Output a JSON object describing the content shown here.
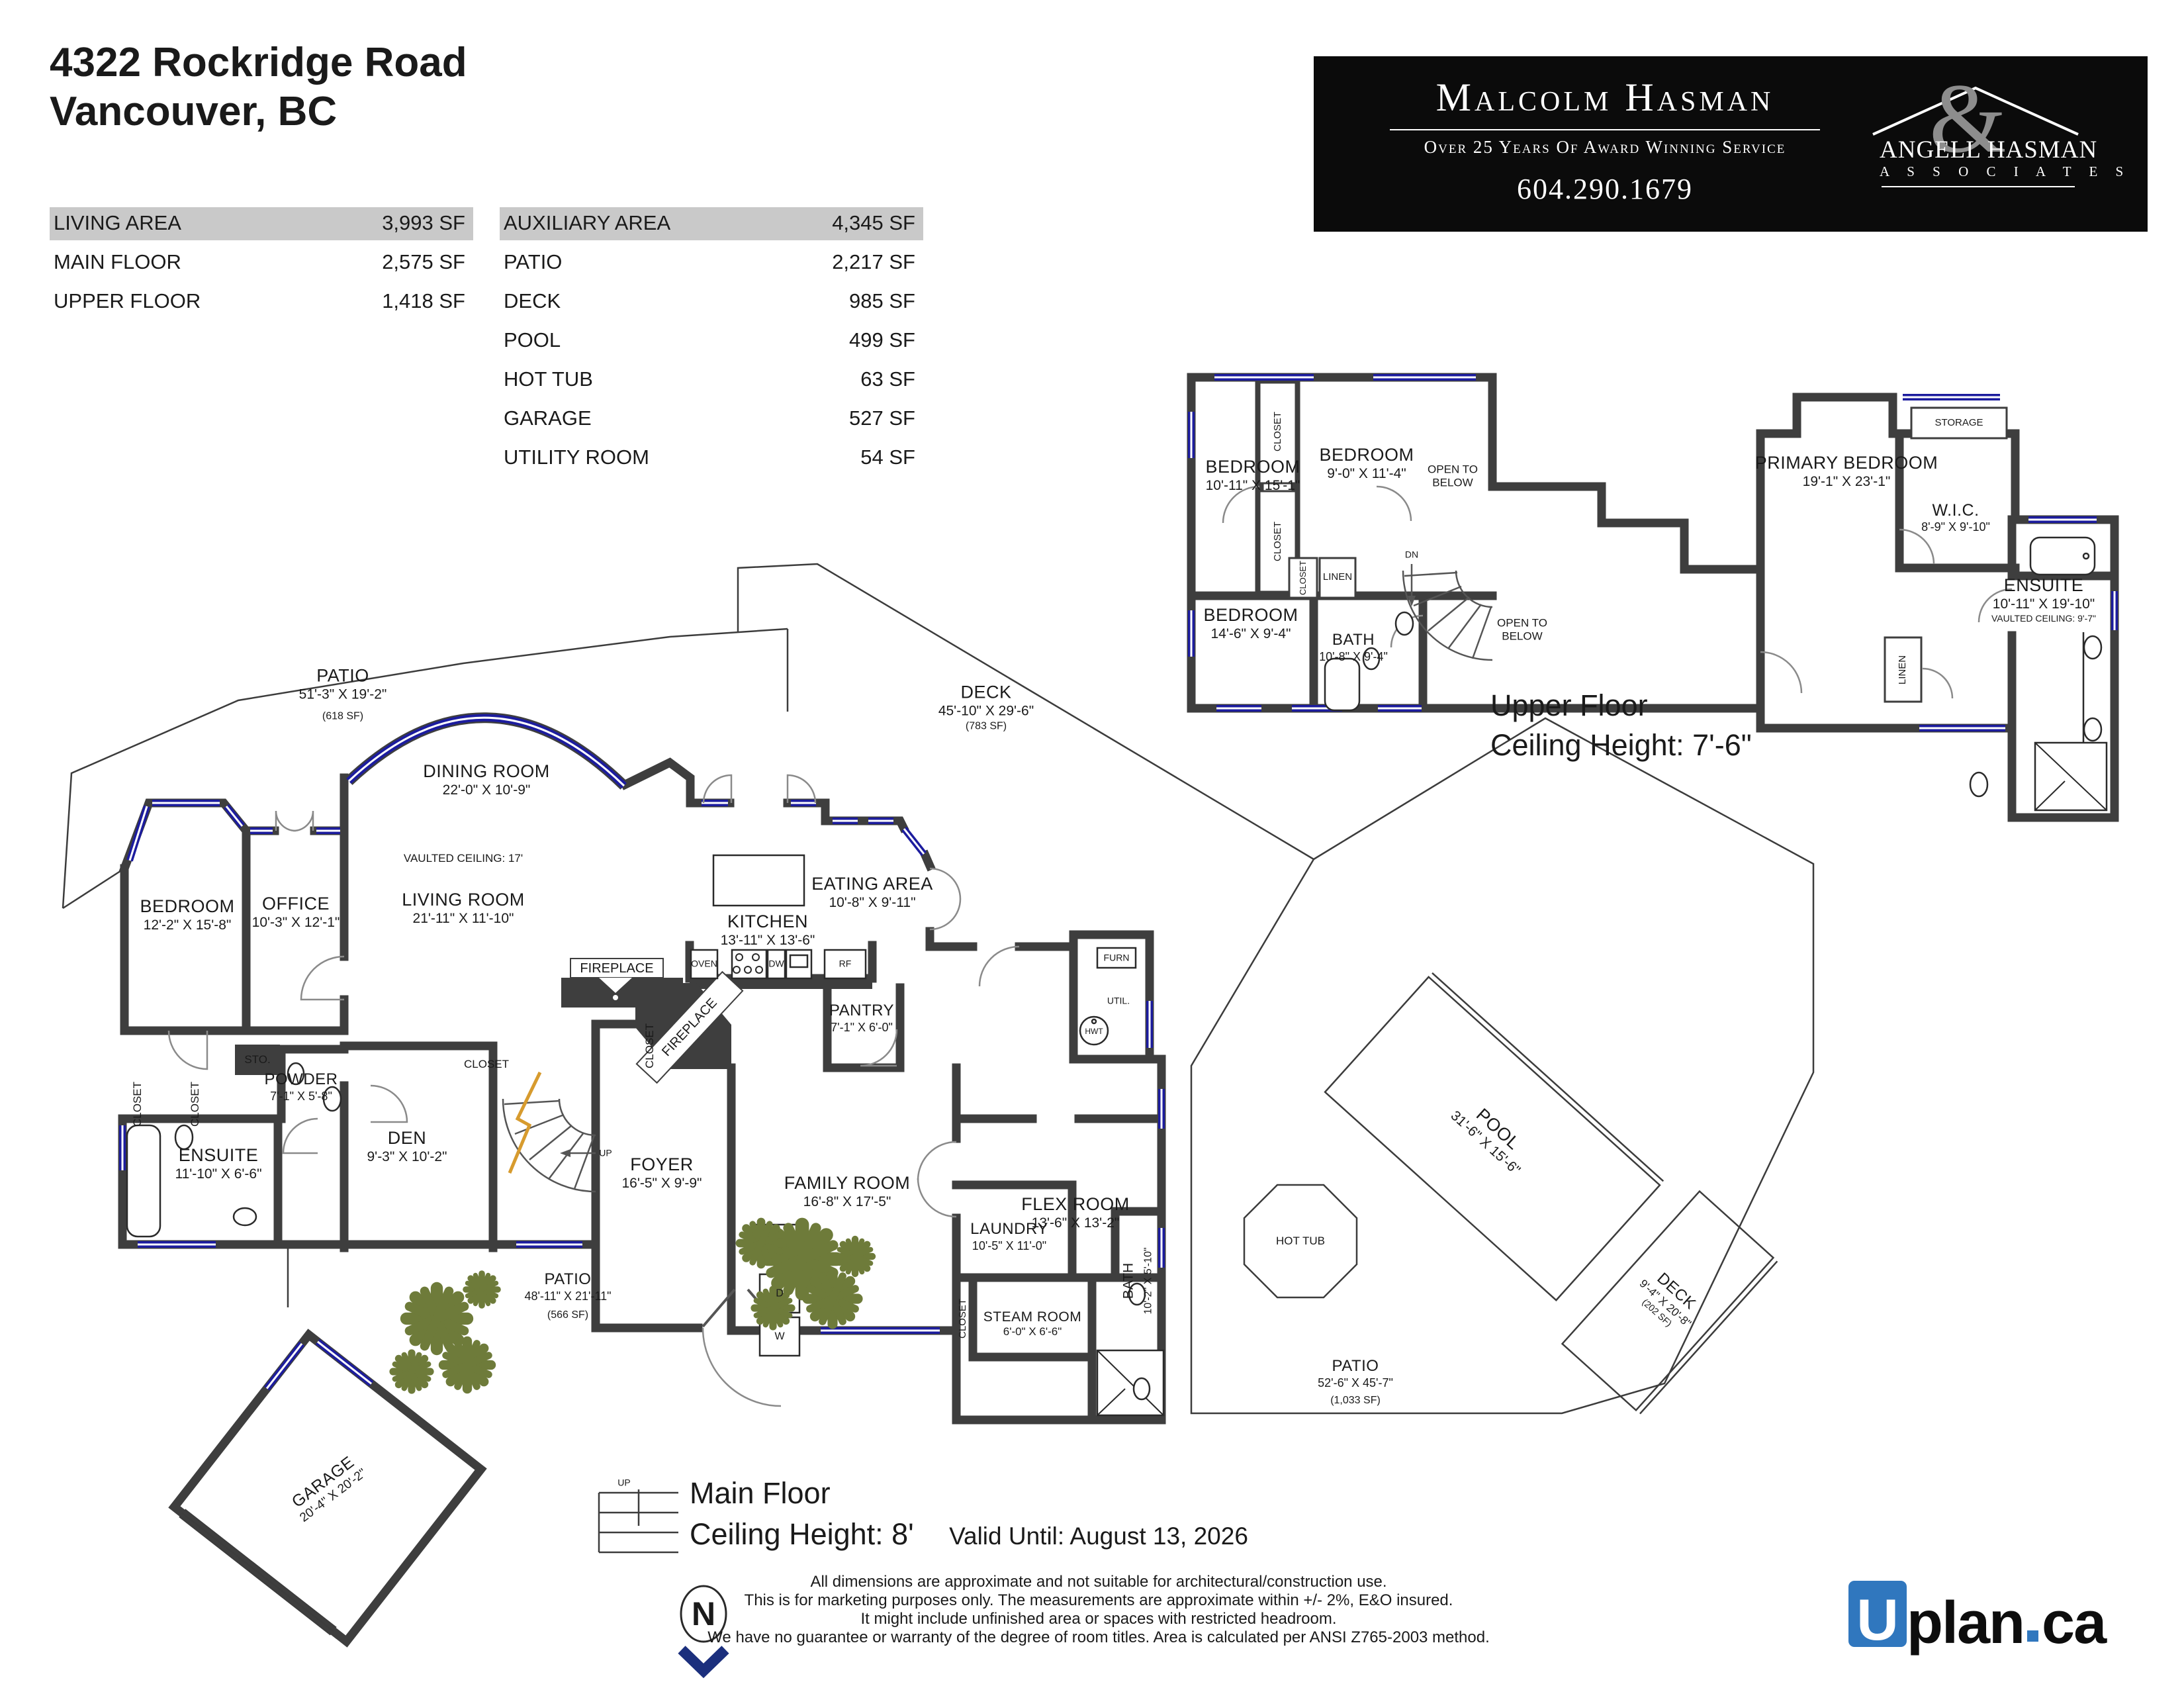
{
  "header": {
    "address_line1": "4322 Rockridge Road",
    "address_line2": "Vancouver, BC"
  },
  "tables": {
    "living": {
      "header": {
        "label": "LIVING AREA",
        "value": "3,993 SF"
      },
      "rows": [
        {
          "label": "MAIN FLOOR",
          "value": "2,575 SF"
        },
        {
          "label": "UPPER FLOOR",
          "value": "1,418 SF"
        }
      ]
    },
    "aux": {
      "header": {
        "label": "AUXILIARY AREA",
        "value": "4,345 SF"
      },
      "rows": [
        {
          "label": "PATIO",
          "value": "2,217 SF"
        },
        {
          "label": "DECK",
          "value": "985 SF"
        },
        {
          "label": "POOL",
          "value": "499 SF"
        },
        {
          "label": "HOT TUB",
          "value": "63 SF"
        },
        {
          "label": "GARAGE",
          "value": "527 SF"
        },
        {
          "label": "UTILITY ROOM",
          "value": "54 SF"
        }
      ]
    }
  },
  "branding": {
    "name": "Malcolm Hasman",
    "tagline": "Over 25 Years Of Award Winning Service",
    "phone": "604.290.1679",
    "partner_line1": "ANGELL HASMAN",
    "partner_amp": "&",
    "partner_line2": "A S S O C I A T E S"
  },
  "colors": {
    "wall": "#3e3e3e",
    "window": "#1c1c9e",
    "plant": "#6e7b3a",
    "table_header_bg": "#c9c9c9",
    "banner_bg": "#0b0b0b",
    "uplan_blue": "#3077be",
    "stair_marker": "#d79b2e",
    "compass_blue": "#1b2f7d"
  },
  "floors": {
    "main": {
      "title": "Main Floor",
      "ceiling": "Ceiling Height: 8'",
      "rooms": [
        {
          "name": "PATIO",
          "dims": "51'-3\" X 19'-2\"",
          "area": "(618 SF)"
        },
        {
          "name": "DINING ROOM",
          "dims": "22'-0\" X 10'-9\""
        },
        {
          "name": "LIVING ROOM",
          "dims": "21'-11\" X 11'-10\"",
          "note": "VAULTED CEILING: 17'"
        },
        {
          "name": "DECK",
          "dims": "45'-10\" X 29'-6\"",
          "area": "(783 SF)"
        },
        {
          "name": "EATING AREA",
          "dims": "10'-8\" X 9'-11\""
        },
        {
          "name": "KITCHEN",
          "dims": "13'-11\" X 13'-6\""
        },
        {
          "name": "BEDROOM",
          "dims": "12'-2\" X 15'-8\""
        },
        {
          "name": "OFFICE",
          "dims": "10'-3\" X 12'-1\""
        },
        {
          "name": "ENSUITE",
          "dims": "11'-10\" X 6'-6\""
        },
        {
          "name": "POWDER",
          "dims": "7'-1\" X 5'-8\""
        },
        {
          "name": "DEN",
          "dims": "9'-3\" X 10'-2\""
        },
        {
          "name": "FOYER",
          "dims": "16'-5\" X 9'-9\""
        },
        {
          "name": "FAMILY ROOM",
          "dims": "16'-8\" X 17'-5\""
        },
        {
          "name": "PANTRY",
          "dims": "7'-1\" X 6'-0\""
        },
        {
          "name": "FLEX ROOM",
          "dims": "13'-6\" X 13'-2\""
        },
        {
          "name": "LAUNDRY",
          "dims": "10'-5\" X 11'-0\""
        },
        {
          "name": "STEAM ROOM",
          "dims": "6'-0\" X 6'-6\""
        },
        {
          "name": "BATH",
          "dims": "10'-2\" X 5'-10\""
        },
        {
          "name": "PATIO",
          "dims": "48'-11\" X 21'-11\"",
          "area": "(566 SF)"
        },
        {
          "name": "GARAGE",
          "dims": "20'-4\" X 20'-2\""
        },
        {
          "name": "POOL",
          "dims": "31'-6\" X 15'-6\""
        },
        {
          "name": "DECK",
          "dims": "9'-4\" X 20'-8\"",
          "area": "(202 SF)"
        },
        {
          "name": "HOT TUB"
        },
        {
          "name": "PATIO",
          "dims": "52'-6\" X 45'-7\"",
          "area": "(1,033 SF)"
        }
      ]
    },
    "upper": {
      "title": "Upper Floor",
      "ceiling": "Ceiling Height: 7'-6\"",
      "rooms": [
        {
          "name": "BEDROOM",
          "dims": "10'-11\" X 15'-1\""
        },
        {
          "name": "BEDROOM",
          "dims": "9'-0\" X 11'-4\""
        },
        {
          "name": "BEDROOM",
          "dims": "14'-6\" X 9'-4\""
        },
        {
          "name": "BATH",
          "dims": "10'-8\" X 9'-4\""
        },
        {
          "name": "PRIMARY BEDROOM",
          "dims": "19'-1\" X 23'-1\""
        },
        {
          "name": "W.I.C.",
          "dims": "8'-9\" X 9'-10\""
        },
        {
          "name": "ENSUITE",
          "dims": "10'-11\" X 19'-10\"",
          "note": "VAULTED CEILING: 9'-7\""
        }
      ]
    }
  },
  "marks": {
    "closet": "CLOSET",
    "sto": "STO.",
    "linen": "LINEN",
    "storage": "STORAGE",
    "open_below": "OPEN TO\nBELOW",
    "open_to": "OPEN TO",
    "below": "BELOW",
    "dn": "DN",
    "up": "UP",
    "fireplace": "FIREPLACE",
    "oven": "OVEN",
    "dw": "DW",
    "rf": "RF",
    "furn": "FURN",
    "util": "UTIL.",
    "hwt": "HWT",
    "d": "D",
    "w": "W",
    "north": "N"
  },
  "footer": {
    "valid": "Valid Until: August 13, 2026",
    "disclaimer": [
      "All dimensions are approximate and not suitable for architectural/construction use.",
      "This is for marketing purposes only. The measurements are approximate within +/- 2%, E&O insured.",
      "It might include unfinished area or spaces with restricted headroom.",
      "We have no guarantee or warranty of the degree of room titles. Area is calculated per ANSI Z765-2003 method."
    ]
  },
  "watermark": {
    "u": "U",
    "plan": "plan",
    "dot": ".",
    "ca": "ca"
  }
}
